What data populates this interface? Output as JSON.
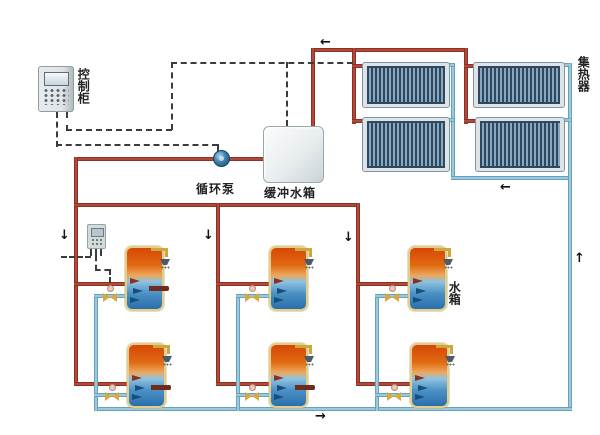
{
  "labels": {
    "control_cabinet": "控制柜",
    "circulation_pump": "循环泵",
    "buffer_tank": "缓冲水箱",
    "solar_collector": "集热器",
    "water_tank": "水箱"
  },
  "flow_arrows": {
    "left": "←",
    "right": "→",
    "up": "↑",
    "down": "↓"
  },
  "colors": {
    "hot_pipe_red": "#a93828",
    "cold_pipe_blue": "#74b6d4",
    "outlet_stub_dark_red": "#6e2c1e",
    "tank_hot_top": "#d64708",
    "tank_cold_bottom": "#2a6fad",
    "tank_border_gold": "#e2cd8a",
    "collector_tube_dark": "#31485c",
    "collector_tube_light": "#87a8c2",
    "control_wire_dashed": "#3c3c3c",
    "shower_pipe_yellow": "#cfa83c",
    "valve_yellow": "#d9a93c"
  },
  "counts": {
    "solar_collector_panels": 4,
    "storage_tanks": 6,
    "valves": 6,
    "showers": 6
  }
}
